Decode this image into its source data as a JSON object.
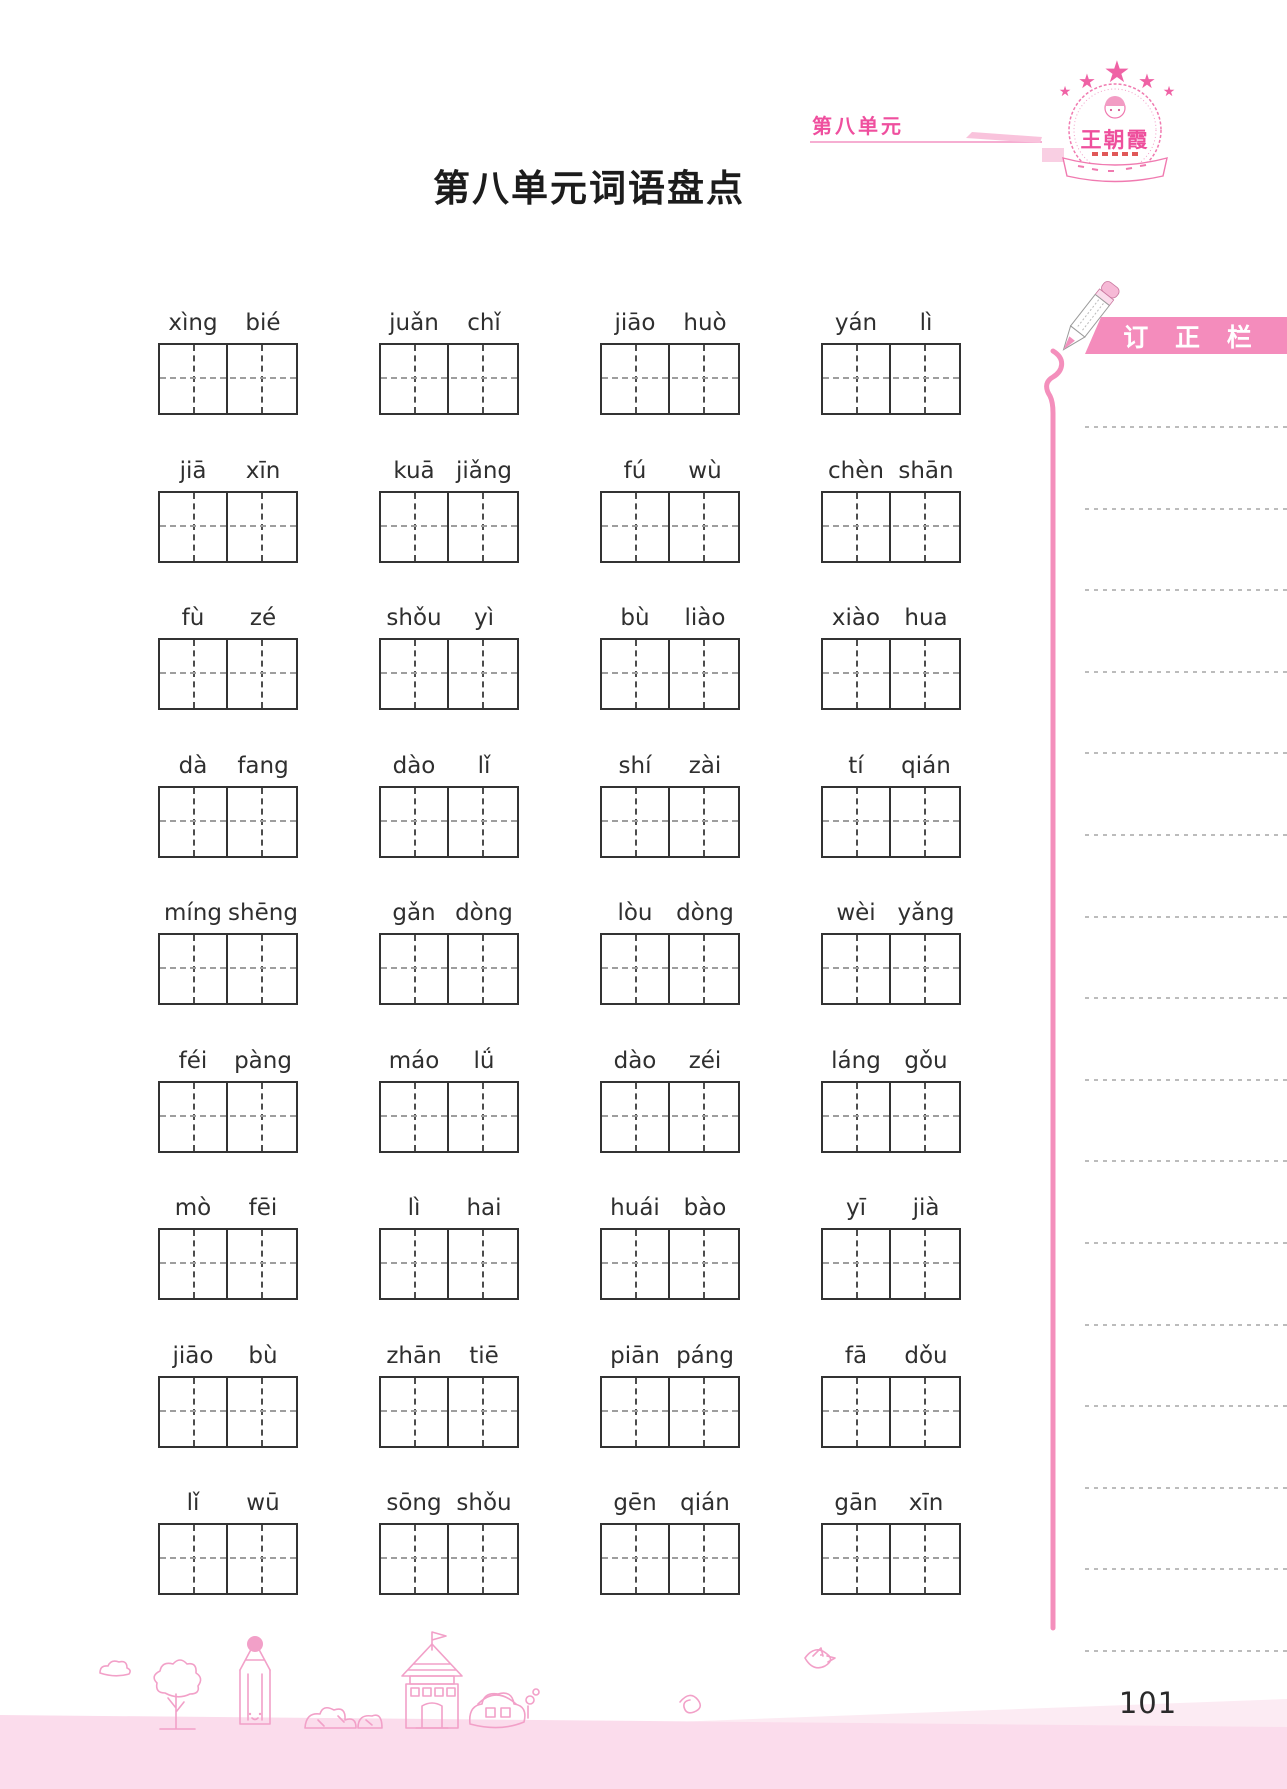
{
  "page": {
    "title": "第八单元词语盘点",
    "page_number": "101"
  },
  "header": {
    "unit_label": "第八单元",
    "logo_brand": "王朝霞",
    "logo_star": "★"
  },
  "correction_panel": {
    "title": "订 正 栏",
    "line_count": 16
  },
  "word_grid": {
    "columns": 4,
    "rows": [
      [
        [
          "xìng",
          "bié"
        ],
        [
          "juǎn",
          "chǐ"
        ],
        [
          "jiāo",
          "huò"
        ],
        [
          "yán",
          "lì"
        ]
      ],
      [
        [
          "jiā",
          "xīn"
        ],
        [
          "kuā",
          "jiǎng"
        ],
        [
          "fú",
          "wù"
        ],
        [
          "chèn",
          "shān"
        ]
      ],
      [
        [
          "fù",
          "zé"
        ],
        [
          "shǒu",
          "yì"
        ],
        [
          "bù",
          "liào"
        ],
        [
          "xiào",
          "hua"
        ]
      ],
      [
        [
          "dà",
          "fang"
        ],
        [
          "dào",
          "lǐ"
        ],
        [
          "shí",
          "zài"
        ],
        [
          "tí",
          "qián"
        ]
      ],
      [
        [
          "míng",
          "shēng"
        ],
        [
          "gǎn",
          "dòng"
        ],
        [
          "lòu",
          "dòng"
        ],
        [
          "wèi",
          "yǎng"
        ]
      ],
      [
        [
          "féi",
          "pàng"
        ],
        [
          "máo",
          "lǘ"
        ],
        [
          "dào",
          "zéi"
        ],
        [
          "láng",
          "gǒu"
        ]
      ],
      [
        [
          "mò",
          "fēi"
        ],
        [
          "lì",
          "hai"
        ],
        [
          "huái",
          "bào"
        ],
        [
          "yī",
          "jià"
        ]
      ],
      [
        [
          "jiāo",
          "bù"
        ],
        [
          "zhān",
          "tiē"
        ],
        [
          "piān",
          "páng"
        ],
        [
          "fā",
          "dǒu"
        ]
      ],
      [
        [
          "lǐ",
          "wū"
        ],
        [
          "sōng",
          "shǒu"
        ],
        [
          "gēn",
          "qián"
        ],
        [
          "gān",
          "xīn"
        ]
      ]
    ]
  },
  "colors": {
    "accent_pink": "#ef4f9e",
    "banner_pink": "#f48cbc",
    "line_pink": "#f48fbc",
    "footer_band": "#fbdcec",
    "doodle_pink": "#f2a0c8",
    "box_border": "#333333",
    "dotted_line": "#bcbcbc",
    "text_dark": "#2f2f2f"
  }
}
